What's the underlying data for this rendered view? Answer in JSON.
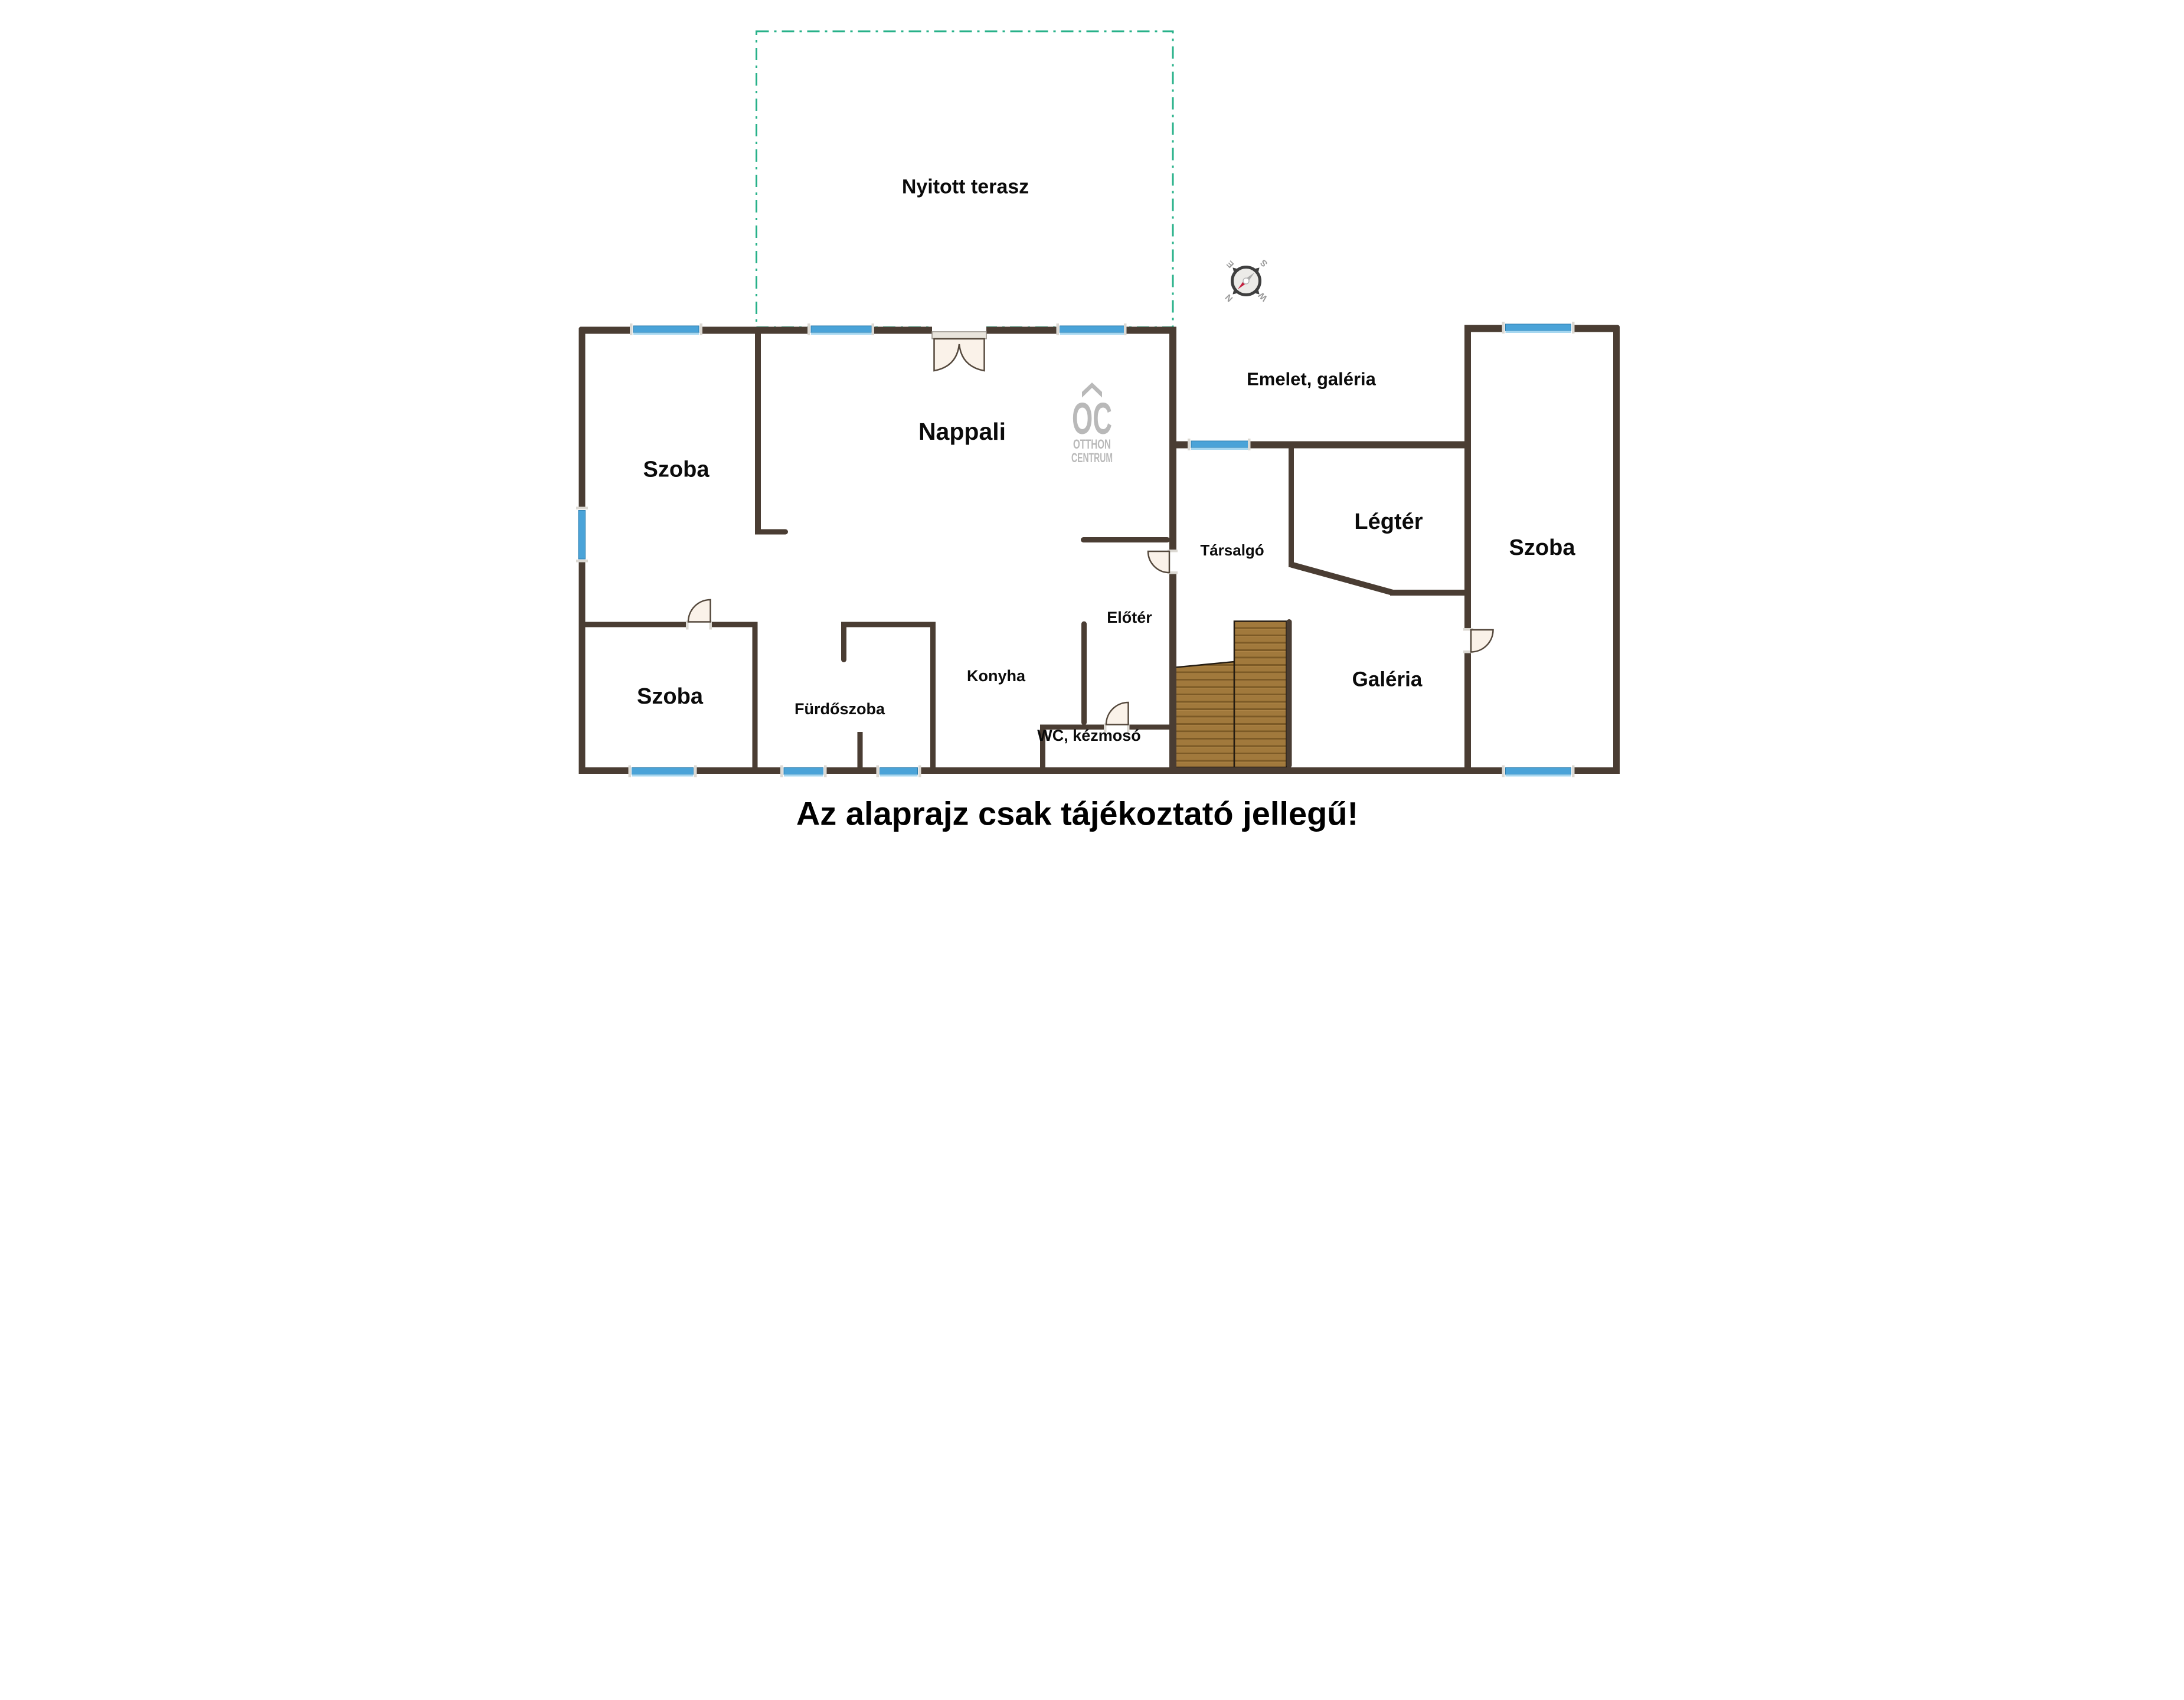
{
  "title": {
    "text": "Az alaprajz csak tájékoztató jellegű!"
  },
  "terrace": {
    "label": "Nyitott terasz"
  },
  "upper_floor": {
    "label": "Emelet, galéria"
  },
  "rooms": {
    "szoba_top_left": "Szoba",
    "nappali": "Nappali",
    "szoba_bottom_left": "Szoba",
    "furdoszoba": "Fürdőszoba",
    "konyha": "Konyha",
    "wc": "WC, kézmosó",
    "eloter": "Előtér",
    "tarsalgo": "Társalgó",
    "legter": "Légtér",
    "galeria": "Galéria",
    "szoba_right": "Szoba"
  },
  "logo": {
    "monogram": "OC",
    "line1": "OTTHON",
    "line2": "CENTRUM"
  },
  "compass": {
    "north": "N",
    "east": "E",
    "south": "S",
    "west": "W"
  },
  "colors": {
    "wall": "#4a3d33",
    "window_blue": "#4aa3d8",
    "window_light": "#a6d7f0",
    "terrace_dash": "#27b189",
    "wood": "#a1793c",
    "wood_dark": "#7c5a26",
    "door_fill": "#faf2e9",
    "logo_gray": "#b9b9b9",
    "needle_red": "#c41f3e"
  }
}
